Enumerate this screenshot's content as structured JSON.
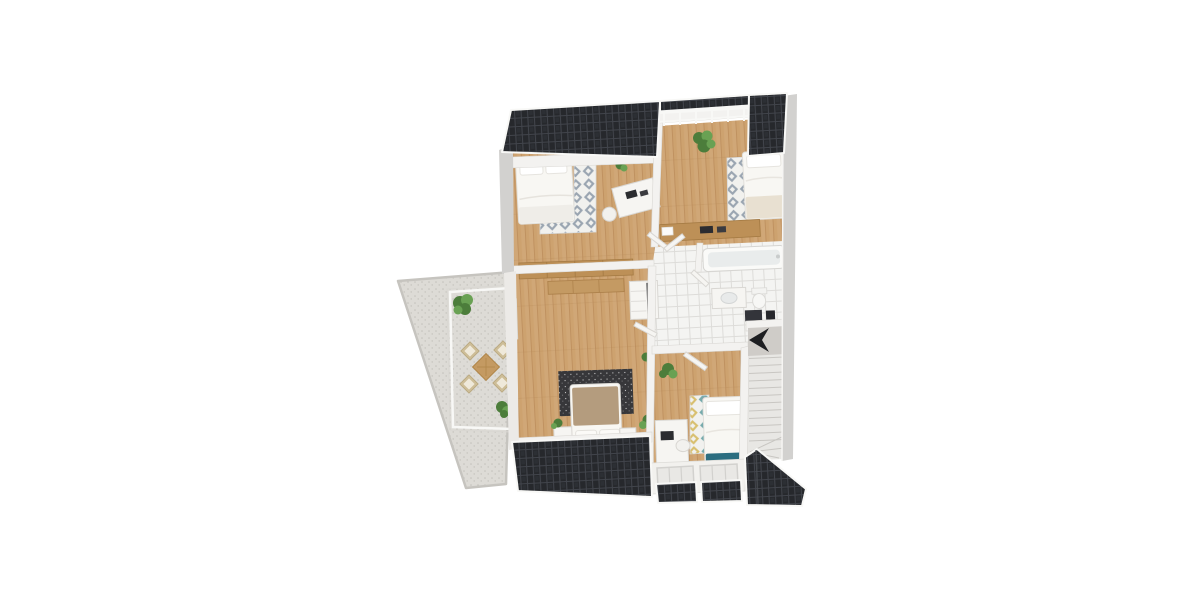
{
  "scene": {
    "title": "3D floor plan rendering, upper storey of a house, top-down view",
    "view": "3d-top-down",
    "visible_text": "",
    "roof_sections": 7,
    "indicators": {
      "stair_arrow_direction": "left-down"
    }
  },
  "rooms": [
    {
      "id": "terrace",
      "label": "terrace",
      "floor": "speckled-stone",
      "features": [
        "glass-railing",
        "dining-table",
        "four-chairs",
        "plant",
        "plant"
      ]
    },
    {
      "id": "bedroom-top-left",
      "label": "bedroom",
      "floor": "wood",
      "features": [
        "double-bed",
        "diamond-rug",
        "desk",
        "laptop",
        "office-chair",
        "desk-plant"
      ]
    },
    {
      "id": "bedroom-top-right",
      "label": "bedroom",
      "floor": "wood",
      "features": [
        "bed",
        "diamond-rug",
        "plant",
        "wood-sideboard",
        "french-balcony-railing"
      ]
    },
    {
      "id": "bathroom",
      "label": "bathroom",
      "floor": "white-tile",
      "features": [
        "bathtub",
        "washbasin-vanity",
        "toilet",
        "dark-radiator"
      ]
    },
    {
      "id": "hallway",
      "label": "hallway",
      "floor": "white-tile",
      "features": [
        "wardrobe-cabinet",
        "plant",
        "doors"
      ]
    },
    {
      "id": "master-bedroom",
      "label": "master bedroom",
      "floor": "wood",
      "features": [
        "double-bed-tan-duvet",
        "two-nightstands",
        "dark-speckled-rug",
        "wood-wardrobe",
        "hall-closet",
        "terrace-door",
        "plants"
      ]
    },
    {
      "id": "bedroom-bottom-right",
      "label": "bedroom",
      "floor": "wood",
      "features": [
        "single-bed",
        "teal-blanket",
        "diamond-rug",
        "desk",
        "laptop",
        "plant",
        "dormer-windows"
      ]
    },
    {
      "id": "staircase",
      "label": "staircase",
      "floor": "carpet",
      "features": [
        "straight-flight",
        "winder-steps",
        "direction-arrow"
      ]
    }
  ],
  "palette": {
    "bg": "#ffffff",
    "roof": "#26282c",
    "roof_line": "#41444b",
    "roof_fascia": "#f8f8f6",
    "wall_outer": "#d2d1cf",
    "wall_inner": "#f3f2f0",
    "wood": "#cda26f",
    "wood_line": "#b98a58",
    "wood_furn": "#bd9057",
    "wood_furn_edge": "#a47a43",
    "tile": "#f4f4f2",
    "tile_line": "#dddcd9",
    "terrace_floor": "#dddbd6",
    "terrace_dot": "#c3c1bb",
    "terrace_edge": "#c6c4bf",
    "stairs": "#e8e7e4",
    "stair_line": "#c8c6c2",
    "stair_landing": "#cfccc8",
    "rug_base": "#f1f1ee",
    "rug_gray": "#9aa5b1",
    "rug_teal": "#76aaac",
    "rug_yellow": "#d8bf6e",
    "rug_dark": "#37373a",
    "bed_white": "#f8f7f3",
    "bed_tan": "#b49c7e",
    "blanket_teal": "#2c6e80",
    "blanket_cream": "#e8e0d1",
    "furn_white": "#f6f5f2",
    "furn_line": "#d9d7d3",
    "dark_item": "#2b2c30",
    "plant": "#4c7d3b",
    "plant_light": "#69a153",
    "arrow": "#1d1e21"
  }
}
